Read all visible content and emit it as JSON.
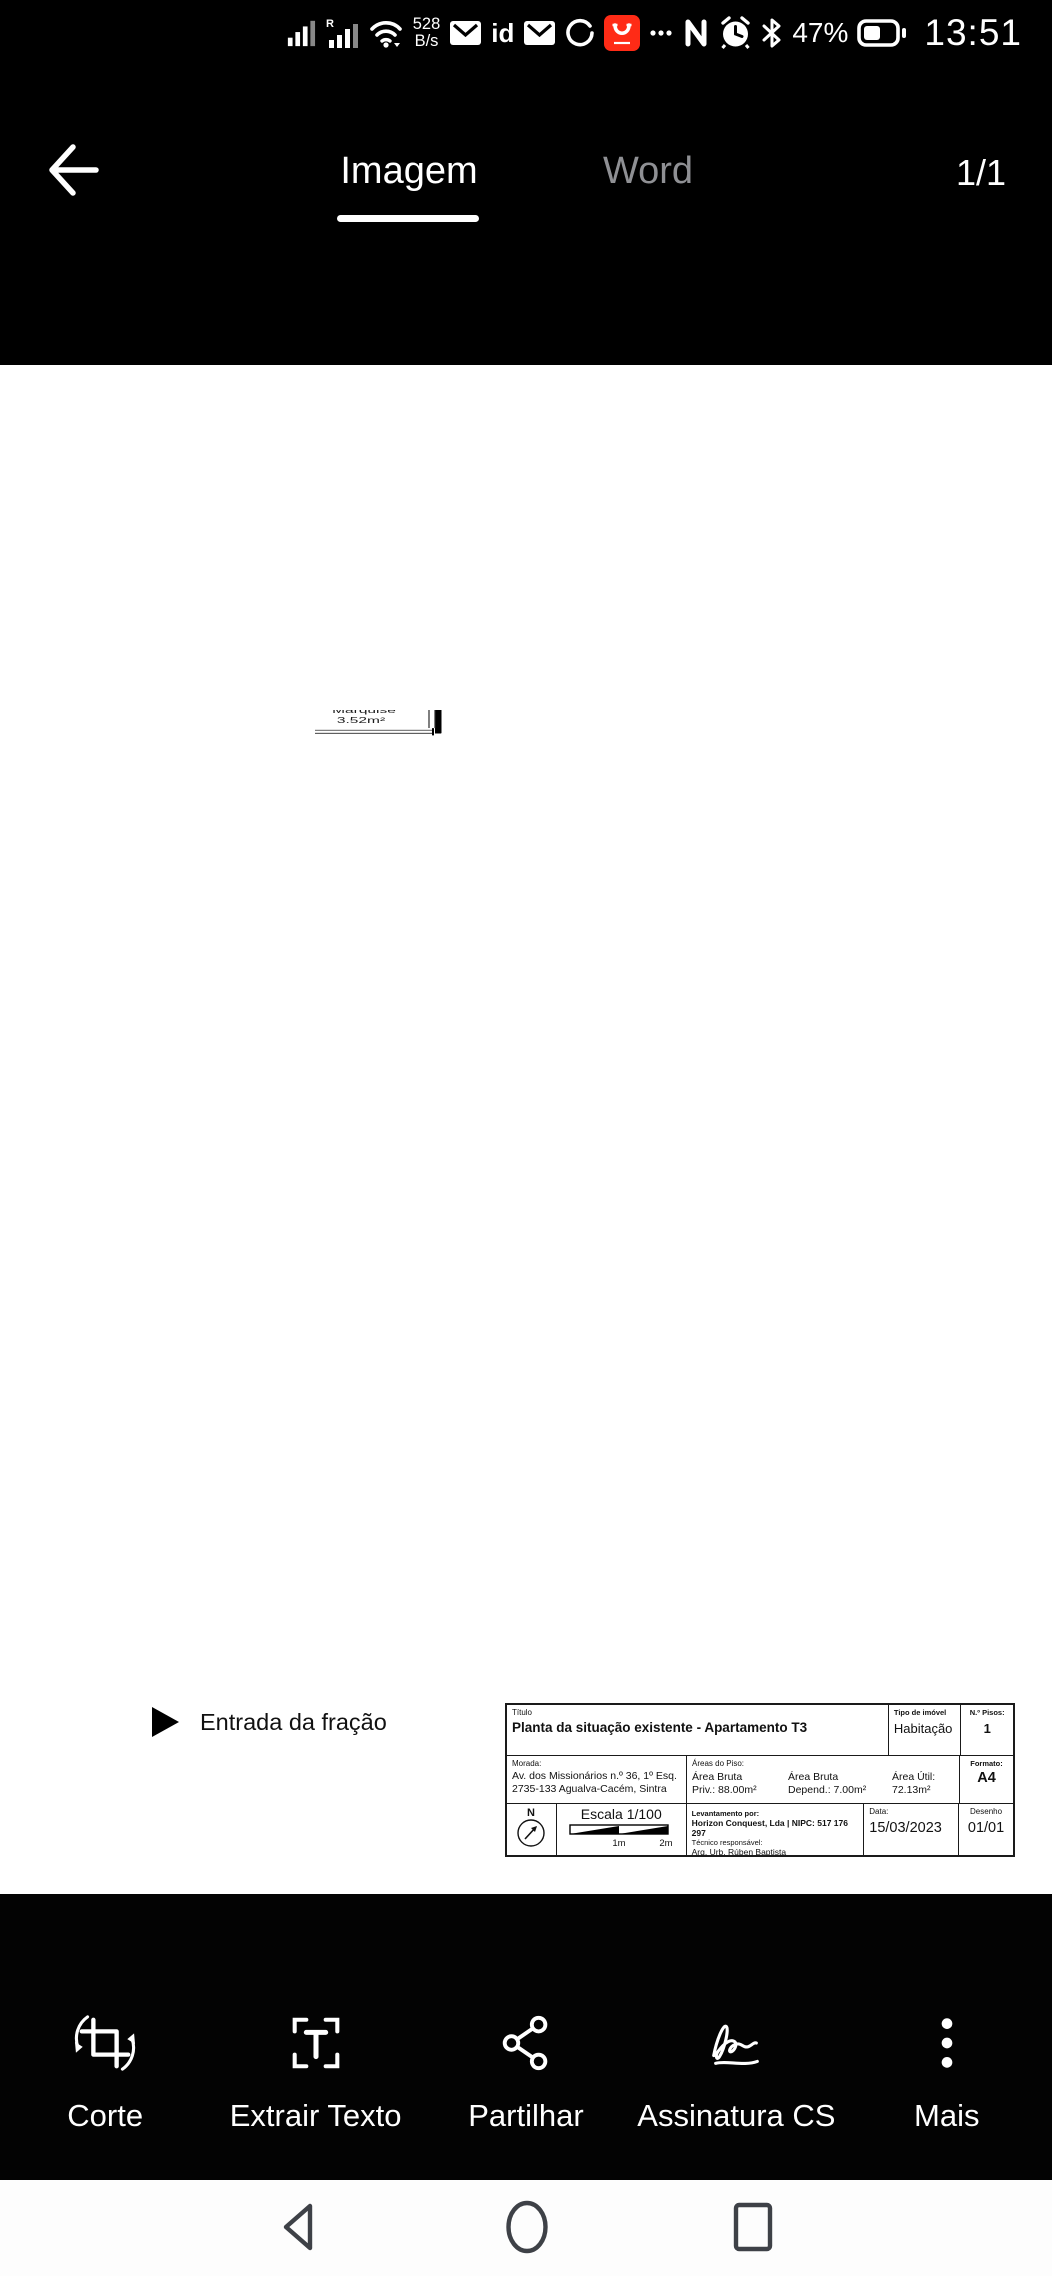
{
  "status_bar": {
    "speed_value": "528",
    "speed_unit": "B/s",
    "id_badge": "id",
    "nfc_glyph": "N",
    "battery_percent": "47%",
    "time": "13:51",
    "icons": [
      "signal-icon",
      "roaming-signal-icon",
      "wifi-icon",
      "mail-icon",
      "id-icon",
      "mail-icon",
      "sync-icon",
      "aliexpress-icon",
      "overflow-dots-icon",
      "nfc-icon",
      "alarm-icon",
      "bluetooth-icon",
      "battery-icon"
    ]
  },
  "header": {
    "tabs": [
      {
        "label": "Imagem",
        "active": true
      },
      {
        "label": "Word",
        "active": false
      }
    ],
    "page_indicator": "1/1"
  },
  "floor_plan": {
    "entrance_label": "Entrada da fração",
    "rooms": [
      {
        "name": "Quarto",
        "area": "10.35m²"
      },
      {
        "name": "Quarto",
        "area": "11.83m²"
      },
      {
        "name": "I.S.",
        "area": "2.13m²"
      },
      {
        "name": "I.S.",
        "area": "4.54m²"
      },
      {
        "name": "Hall",
        "area": "9.02m²"
      },
      {
        "name": "Sala",
        "area": "13.43m²"
      },
      {
        "name": "Cozinha",
        "area": "9.21m²"
      },
      {
        "name": "Quarto",
        "area": "11.62m²"
      },
      {
        "name": "Marquise",
        "area": "3.92m²"
      },
      {
        "name": "Marquise",
        "area": "3.52m²"
      }
    ]
  },
  "title_block": {
    "titulo_label": "Título",
    "titulo": "Planta da situação existente - Apartamento T3",
    "tipo_imovel_label": "Tipo de imóvel",
    "tipo_imovel": "Habitação",
    "n_pisos_label": "N.º Pisos:",
    "n_pisos": "1",
    "morada_label": "Morada:",
    "morada_line1": "Av. dos Missionários n.º 36, 1º Esq.",
    "morada_line2": "2735-133 Agualva-Cacém, Sintra",
    "areas_piso_label": "Áreas do Piso:",
    "area_bruta_priv_label": "Área Bruta",
    "area_bruta_priv": "Priv.: 88.00m²",
    "area_bruta_dep_label": "Área Bruta",
    "area_bruta_dep": "Depend.: 7.00m²",
    "area_util_label": "Área Útil:",
    "area_util": "72.13m²",
    "formato_label": "Formato:",
    "formato": "A4",
    "north_label": "N",
    "escala": "Escala 1/100",
    "scale_tick_1": "1m",
    "scale_tick_2": "2m",
    "levantamento_label": "Levantamento por:",
    "levantamento_company": "Horizon Conquest, Lda | NIPC: 517 176 297",
    "tecnico_label": "Técnico responsável:",
    "tecnico_nome": "Arq. Urb. Rúben Baptista",
    "data_label": "Data:",
    "data_valor": "15/03/2023",
    "desenho_label": "Desenho",
    "desenho_valor": "01/01"
  },
  "toolbar": {
    "items": [
      {
        "label": "Corte",
        "icon": "crop-icon"
      },
      {
        "label": "Extrair Texto",
        "icon": "extract-text-icon"
      },
      {
        "label": "Partilhar",
        "icon": "share-icon"
      },
      {
        "label": "Assinatura CS",
        "icon": "signature-icon"
      },
      {
        "label": "Mais",
        "icon": "more-icon"
      }
    ]
  },
  "nav_bar": {
    "icons": [
      "back-icon",
      "home-icon",
      "recents-icon"
    ]
  },
  "colors": {
    "accent_red": "#ff2b16",
    "tab_inactive": "#8f9094",
    "nav_icon": "#3e4147"
  }
}
